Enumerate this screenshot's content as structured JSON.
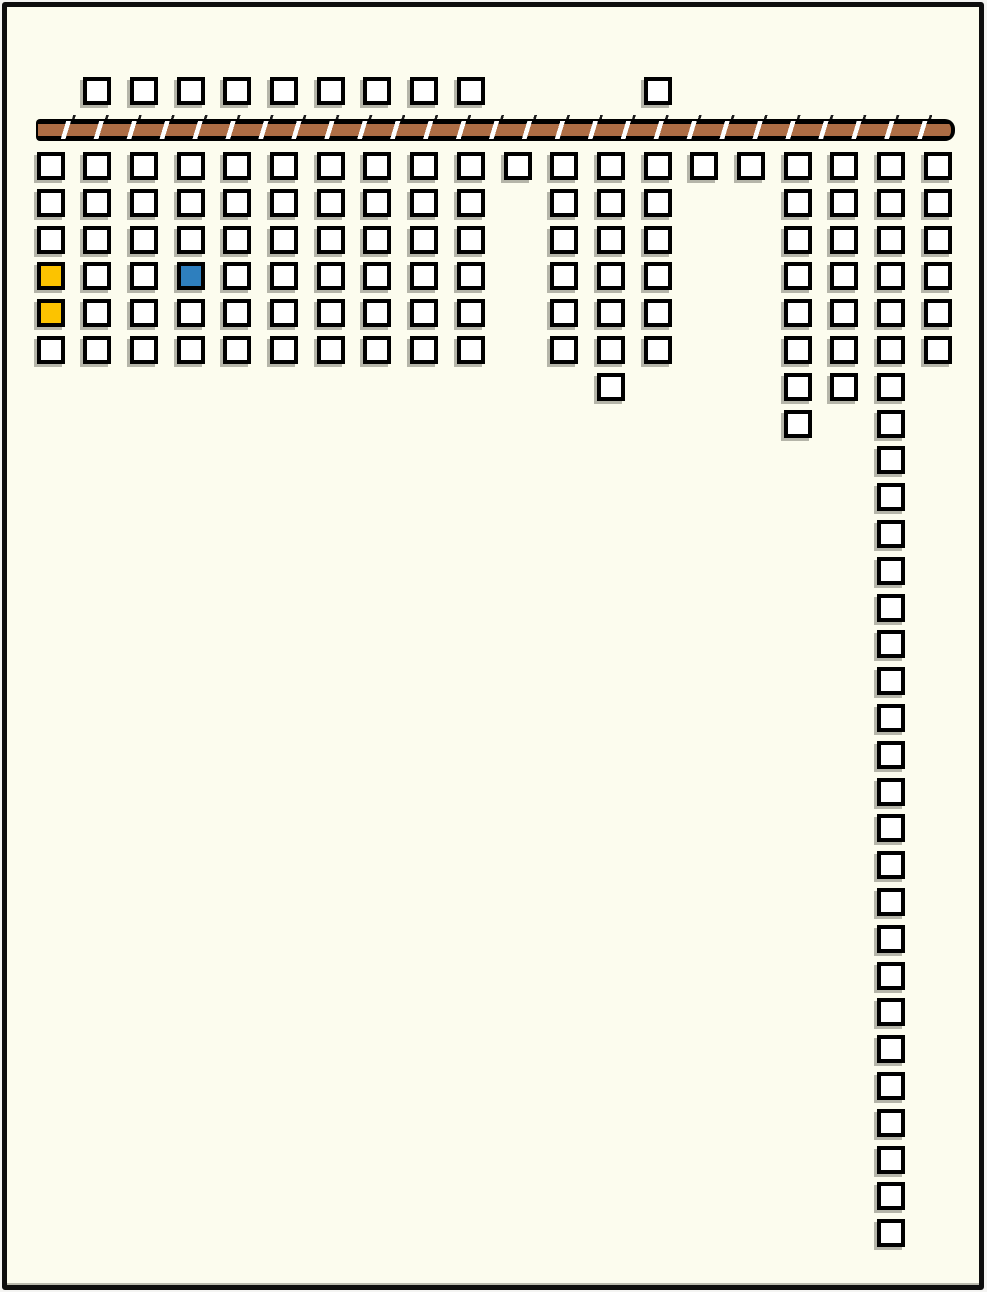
{
  "canvas": {
    "width": 987,
    "height": 1292,
    "background_color": "#fcfcee",
    "frame_color": "#0e0e0e"
  },
  "palette": {
    "cell_fill": "#ffffff",
    "cell_border": "#000000",
    "yellow": "#fcc300",
    "blue": "#2e7fbe",
    "bar_fill": "#ad6d45",
    "bar_gap": "#ffffff",
    "bar_outline": "#000000"
  },
  "board": {
    "cell_size": 28,
    "col_pitch": 46.7,
    "row_pitch": 36.8,
    "origin_x": 36.5,
    "rows_origin_y": 152,
    "top_row": {
      "y": 77,
      "cols": [
        1,
        2,
        3,
        4,
        5,
        6,
        7,
        8,
        9,
        13
      ]
    },
    "hatched_bar": {
      "x": 36,
      "y": 119,
      "width": 919,
      "height": 22
    },
    "rows": [
      {
        "r": 0,
        "cols": [
          0,
          1,
          2,
          3,
          4,
          5,
          6,
          7,
          8,
          9,
          10,
          11,
          12,
          13,
          14,
          15,
          16,
          17,
          18,
          19
        ]
      },
      {
        "r": 1,
        "cols": [
          0,
          1,
          2,
          3,
          4,
          5,
          6,
          7,
          8,
          9,
          11,
          12,
          13,
          16,
          17,
          18,
          19
        ]
      },
      {
        "r": 2,
        "cols": [
          0,
          1,
          2,
          3,
          4,
          5,
          6,
          7,
          8,
          9,
          11,
          12,
          13,
          16,
          17,
          18,
          19
        ]
      },
      {
        "r": 3,
        "cols": [
          0,
          1,
          2,
          3,
          4,
          5,
          6,
          7,
          8,
          9,
          11,
          12,
          13,
          16,
          17,
          18,
          19
        ]
      },
      {
        "r": 4,
        "cols": [
          0,
          1,
          2,
          3,
          4,
          5,
          6,
          7,
          8,
          9,
          11,
          12,
          13,
          16,
          17,
          18,
          19
        ]
      },
      {
        "r": 5,
        "cols": [
          0,
          1,
          2,
          3,
          4,
          5,
          6,
          7,
          8,
          9,
          11,
          12,
          13,
          16,
          17,
          18,
          19
        ]
      },
      {
        "r": 6,
        "cols": [
          12,
          16,
          17,
          18
        ]
      },
      {
        "r": 7,
        "cols": [
          16,
          18
        ]
      },
      {
        "r": 8,
        "cols": [
          18
        ]
      },
      {
        "r": 9,
        "cols": [
          18
        ]
      },
      {
        "r": 10,
        "cols": [
          18
        ]
      },
      {
        "r": 11,
        "cols": [
          18
        ]
      },
      {
        "r": 12,
        "cols": [
          18
        ]
      },
      {
        "r": 13,
        "cols": [
          18
        ]
      },
      {
        "r": 14,
        "cols": [
          18
        ]
      },
      {
        "r": 15,
        "cols": [
          18
        ]
      },
      {
        "r": 16,
        "cols": [
          18
        ]
      },
      {
        "r": 17,
        "cols": [
          18
        ]
      },
      {
        "r": 18,
        "cols": [
          18
        ]
      },
      {
        "r": 19,
        "cols": [
          18
        ]
      },
      {
        "r": 20,
        "cols": [
          18
        ]
      },
      {
        "r": 21,
        "cols": [
          18
        ]
      },
      {
        "r": 22,
        "cols": [
          18
        ]
      },
      {
        "r": 23,
        "cols": [
          18
        ]
      },
      {
        "r": 24,
        "cols": [
          18
        ]
      },
      {
        "r": 25,
        "cols": [
          18
        ]
      },
      {
        "r": 26,
        "cols": [
          18
        ]
      },
      {
        "r": 27,
        "cols": [
          18
        ]
      },
      {
        "r": 28,
        "cols": [
          18
        ]
      },
      {
        "r": 29,
        "cols": [
          18
        ]
      }
    ],
    "colored_cells": [
      {
        "r": 3,
        "col": 0,
        "color": "yellow"
      },
      {
        "r": 4,
        "col": 0,
        "color": "yellow"
      },
      {
        "r": 3,
        "col": 3,
        "color": "blue"
      }
    ]
  }
}
